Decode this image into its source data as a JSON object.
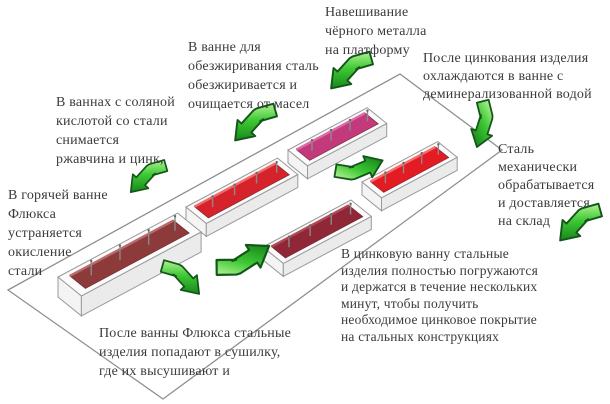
{
  "labels": {
    "hanging": "Навешивание\nчёрного металла\nна платформу",
    "degreasing": "В ванне для\nобезжиривания сталь\nобезжиривается и\nочищается от масел",
    "acid": "В ваннах с соляной\nкислотой со стали\nснимается\nржавчина и цинк,",
    "flux": "В горячей ванне\nФлюкса\nустраняется\nокисление\nстали",
    "cooling": "После цинкования изделия\nохлаждаются в ванне с\nдеминерализованной водой",
    "mechanical": "Сталь\nмеханически\nобрабатывается\nи доставляется\nна склад",
    "dryer": "После ванны Флюкса стальные\nизделия попадают в сушилку,\nгде их высушивают и",
    "zinc": "В цинковую ванну стальные\nизделия полностью погружаются\nи держатся в течение нескольких\nминут, чтобы получить\nнеобходимое цинковое покрытие\nна стальных конструкциях"
  },
  "colors": {
    "text": "#3b3b3b",
    "outline": "#8f8f8f",
    "bath_rim": "#fbfbfb",
    "bath_side": "#f4f4f4",
    "bath_side_dark": "#ebebeb",
    "bath_stroke": "#9a9a9a",
    "arrow_light": "#b2f295",
    "arrow_mid": "#3fc934",
    "arrow_dark": "#17871b",
    "arrow_stroke": "#14561a",
    "pin": "#8a8a8a"
  },
  "baths": [
    {
      "name": "flux-bath-large-dark-red",
      "fill": "#8c3a3a",
      "highlight": "#b96a6a"
    },
    {
      "name": "degreasing-bath-red",
      "fill": "#d6232b",
      "highlight": "#ef6a6a"
    },
    {
      "name": "acid-bath-pink",
      "fill": "#c23a7c",
      "highlight": "#dd6aa6"
    },
    {
      "name": "rinse-bath-bright-red",
      "fill": "#e31b22",
      "highlight": "#f96b6b"
    },
    {
      "name": "zinc-bath-maroon",
      "fill": "#8f2736",
      "highlight": "#b04a58"
    }
  ]
}
